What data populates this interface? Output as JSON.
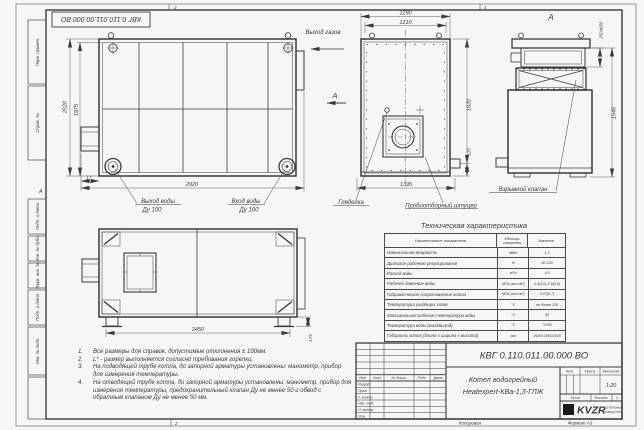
{
  "frame": {
    "side_column": [
      "Перв. примен.",
      "Справ. №",
      "Подп. и дата",
      "Инв. № дубл.",
      "Взам. инв. №",
      "Подп. и дата",
      "Инв. № подл."
    ],
    "zone_top_left": "2",
    "zone_top_right": "1",
    "zone_bottom": "2",
    "zone_left_letter": "А"
  },
  "stamp": {
    "number": "КВГ 0.110.011.00.000 ВО"
  },
  "views": {
    "rear": {
      "dim_height_outer": "2020",
      "dim_height_inner": "1975",
      "dim_width": "2920",
      "dim_burner": "L*",
      "label_water_out": "Выход воды",
      "label_water_out_dn": "Ду 100",
      "label_water_in": "Вход воды",
      "label_water_in_dn": "Ду 100"
    },
    "front": {
      "dim_top_outer": "1290",
      "dim_top_inner": "1210",
      "dim_height": "1820",
      "dim_bottom_offset": "125",
      "dim_width": "1395",
      "label_gas_out": "Выход газов",
      "view_arrow": "А",
      "label_sight": "Гляделка",
      "label_sampling": "Пробоотборный штуцер"
    },
    "section": {
      "title": "А",
      "dim_valve": "250х600",
      "dim_height": "1540",
      "label_valve": "Взрывной клапан"
    },
    "side": {
      "dim_length": "2450",
      "dim_base": "175"
    }
  },
  "tech": {
    "title": "Техническая характеристика",
    "headers": [
      "Наименование показателя",
      "Единицы измерения",
      "Значение"
    ],
    "rows": [
      {
        "name": "Номинальная мощность",
        "unit": "МВт",
        "value": "1,3"
      },
      {
        "name": "Диапазон рабочего регулирования",
        "unit": "%",
        "value": "40-100"
      },
      {
        "name": "Расход воды",
        "unit": "м³/ч",
        "value": "4,5"
      },
      {
        "name": "Рабочее давление воды",
        "unit": "МПа (кгс/см²)",
        "value": "0,3(3,0)-0,6(6,0)"
      },
      {
        "name": "Гидравлическое сопротивление котла",
        "unit": "МПа (кгс/см²)",
        "value": "0,07(0,7)"
      },
      {
        "name": "Температура уходящих газов",
        "unit": "°С",
        "value": "не более 220"
      },
      {
        "name": "Максимальная рабочая температура воды",
        "unit": "°С",
        "value": "95"
      },
      {
        "name": "Температура воды (вход/выход)",
        "unit": "°С",
        "value": "70/95"
      },
      {
        "name": "Габариты котла (длина х ширина х высота)",
        "unit": "мм",
        "value": "2920х1395х2020"
      }
    ]
  },
  "notes": [
    {
      "num": "1.",
      "text": "Все размеры для справок, допустимые отклонения ± 100мм."
    },
    {
      "num": "2.",
      "text": "L* - размер выполняется согласно требования горелки."
    },
    {
      "num": "3.",
      "text": "На подводящей трубе котла, до запорной арматуры установлены: манометр, прибор для измерения температуры."
    },
    {
      "num": "4.",
      "text": "На отводящей трубе котла, до запорной арматуры установлены: манометр, прибор для измерения температуры, предохранительный клапан Ду не менее 50 и обвод с обратным клапаном Ду не менее 50 мм."
    }
  ],
  "title_block": {
    "doc_number": "КВГ 0.110.011.00.000 ВО",
    "name_line1": "Котел водогрейный",
    "name_line2": "Heatexpert-КВа-1,3-ГЛЖ",
    "lit_label": "Лит.",
    "mass_label": "Масса",
    "scale_label": "Масштаб",
    "scale_value": "1:20",
    "sheet_label": "Лист",
    "sheets_label": "Листов",
    "sheets_value": "1",
    "header_cols": [
      "Изм.",
      "Лист",
      "№ докум.",
      "Подп.",
      "Дата"
    ],
    "roles": [
      "Разраб.",
      "Пров.",
      "Т. контр.",
      "Нач. отд.",
      "Н. контр.",
      "Утв."
    ],
    "company_logo": "KVZR",
    "company_line1": "КОТЕЛЬНЫЙ",
    "company_line2": "ЗАВОД РЭП",
    "copied_label": "Копировал",
    "format_label": "Формат А3"
  }
}
